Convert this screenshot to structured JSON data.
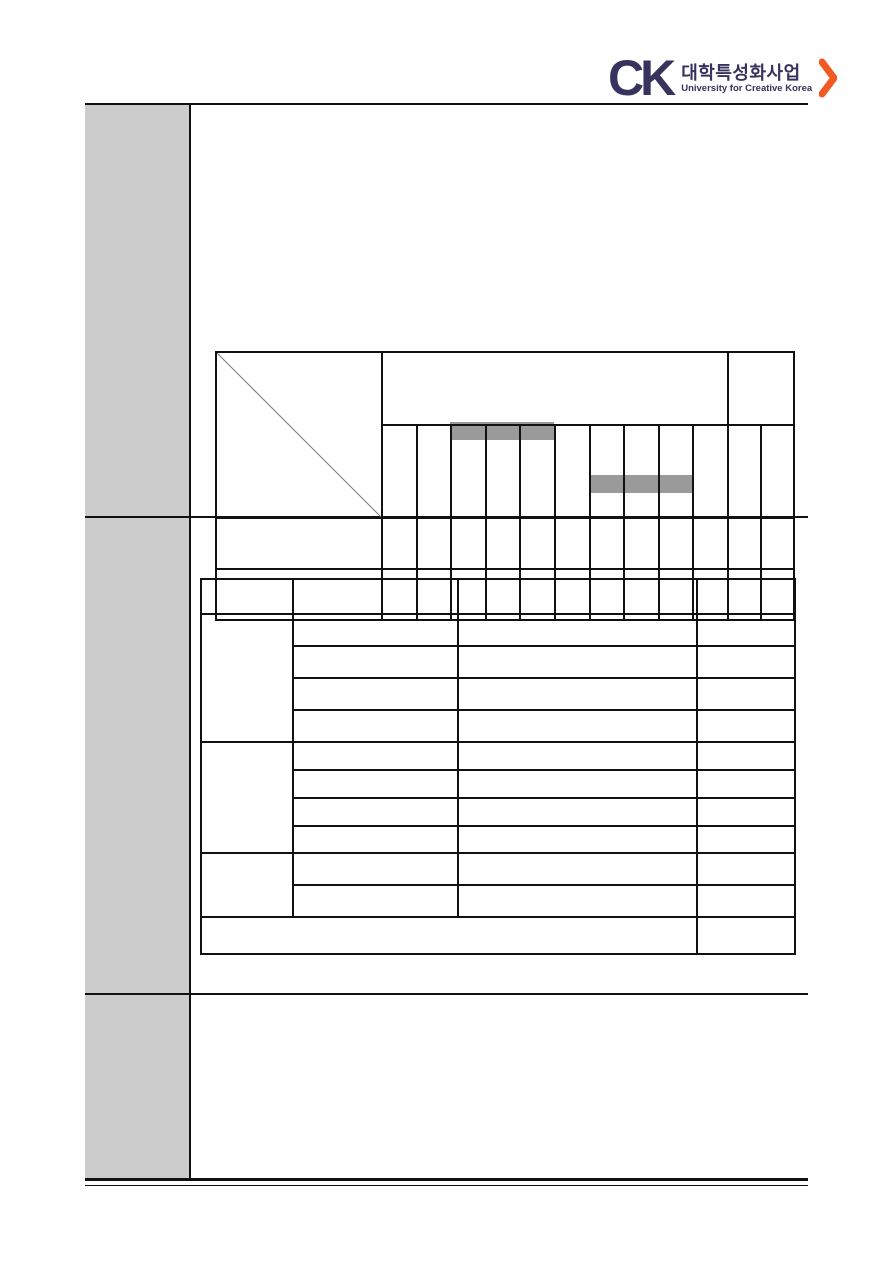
{
  "logo": {
    "mark": "CK",
    "korean": "대학특성화사업",
    "english": "University for Creative Korea",
    "navy": "#37335E",
    "orange": "#F15A22"
  },
  "layout_colors": {
    "sidebar_fill": "#CCCCCC",
    "rule_color": "#111111"
  },
  "gantt": {
    "type": "gantt",
    "corner_cell_diagonal": true,
    "main_header_span": 10,
    "right_header_span": 2,
    "sub_columns": 12,
    "task_rows": 2,
    "bars": [
      {
        "row": 1,
        "start_col": 3,
        "end_col": 5
      },
      {
        "row": 2,
        "start_col": 7,
        "end_col": 9
      }
    ],
    "bar_color": "#9A9A9A",
    "cells_empty": true
  },
  "detail_table": {
    "columns": 4,
    "header_row": 1,
    "groups": [
      {
        "rows": 4
      },
      {
        "rows": 4
      },
      {
        "rows": 2
      }
    ],
    "total_row": {
      "merged_columns": 3,
      "value_column": 1
    },
    "cells_empty": true
  }
}
